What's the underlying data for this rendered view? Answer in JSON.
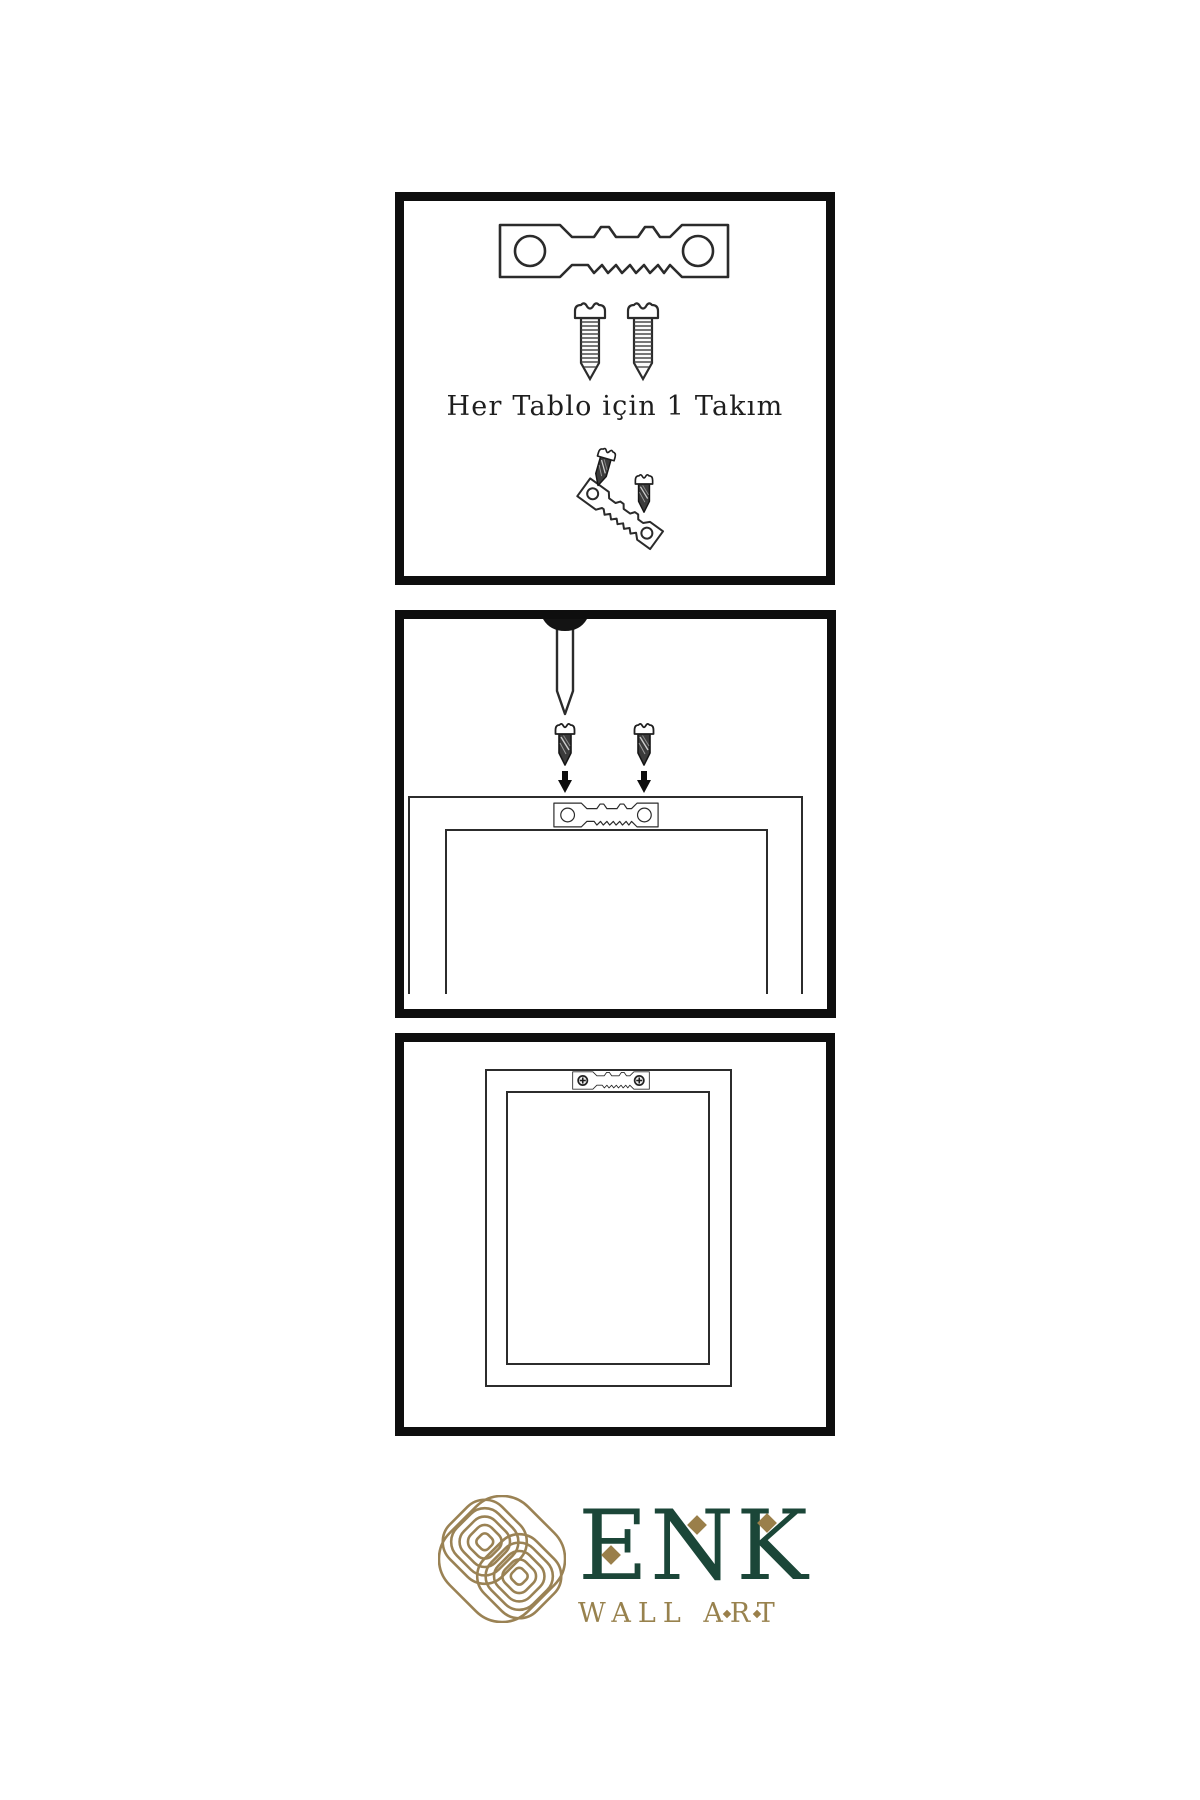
{
  "meta": {
    "type": "wall-art hanging instruction sheet",
    "background": "#ffffff"
  },
  "colors": {
    "panel_border": "#0e0e0e",
    "line_art": "#2c2c2c",
    "screw_dark_fill": "#3b3b3b",
    "logo_green": "#1b4638",
    "logo_gold": "#98824e"
  },
  "steps": [
    {
      "id": "kit",
      "caption": "Her Tablo için 1 Takım",
      "icons": [
        "sawtooth-hanger-icon",
        "screw-icon",
        "screw-icon",
        "hanger-screw-assembly-icon"
      ]
    },
    {
      "id": "mount",
      "icons": [
        "nail-icon",
        "screw-icon",
        "screw-icon",
        "arrow-down-icon",
        "arrow-down-icon",
        "sawtooth-hanger-icon",
        "frame-back-outline"
      ]
    },
    {
      "id": "hang",
      "icons": [
        "frame-back-outline",
        "sawtooth-hanger-mounted-icon"
      ]
    }
  ],
  "logo": {
    "brand": "ENK",
    "tagline": "WALL ART",
    "icons": [
      "knot-logo-icon",
      "diamond-accent-icon"
    ]
  }
}
